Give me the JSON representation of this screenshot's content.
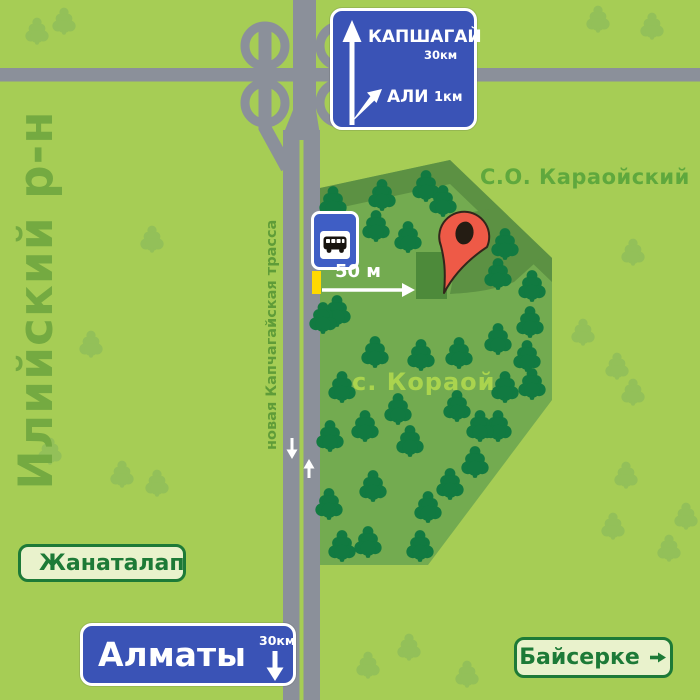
{
  "map": {
    "region_label": "Илийский р-н",
    "road_label": "новая Капчагайская трасса",
    "district_label": "С.О. Караойский",
    "village_label": "с. Кораой",
    "distance_label": "50 м",
    "colors": {
      "background": "#a6cd55",
      "road": "#8b909a",
      "forest": "#73ab50",
      "forest_shadow": "#5c9143",
      "tree_dark": "#117a41",
      "tree_light": "#93c059",
      "building": "#4d8a3a",
      "sign_blue": "#3a53b6",
      "bus_sign_blue": "#3f5ec5",
      "bus_stop_yellow": "#ffd900",
      "marker_red": "#ee5a47",
      "marker_outline": "#33261b",
      "green_sign_bg": "#e9f2cc",
      "green_sign_text": "#1d7a37",
      "district_text": "#5fa83d",
      "village_text": "#aad44e",
      "region_text": "#74aa41",
      "road_label_text": "#5f9c38"
    },
    "trees_dark": [
      [
        333,
        203
      ],
      [
        382,
        196
      ],
      [
        426,
        187
      ],
      [
        443,
        202
      ],
      [
        376,
        227
      ],
      [
        408,
        238
      ],
      [
        337,
        312
      ],
      [
        323,
        319
      ],
      [
        375,
        353
      ],
      [
        421,
        356
      ],
      [
        459,
        354
      ],
      [
        505,
        245
      ],
      [
        498,
        275
      ],
      [
        532,
        287
      ],
      [
        530,
        323
      ],
      [
        498,
        340
      ],
      [
        527,
        357
      ],
      [
        505,
        388
      ],
      [
        532,
        385
      ],
      [
        498,
        427
      ],
      [
        342,
        388
      ],
      [
        398,
        410
      ],
      [
        457,
        407
      ],
      [
        365,
        427
      ],
      [
        480,
        427
      ],
      [
        330,
        437
      ],
      [
        410,
        442
      ],
      [
        475,
        463
      ],
      [
        450,
        485
      ],
      [
        373,
        487
      ],
      [
        329,
        505
      ],
      [
        428,
        508
      ],
      [
        342,
        547
      ],
      [
        368,
        543
      ],
      [
        420,
        547
      ]
    ],
    "trees_light": [
      [
        37,
        32
      ],
      [
        64,
        22
      ],
      [
        598,
        20
      ],
      [
        652,
        27
      ],
      [
        152,
        240
      ],
      [
        91,
        345
      ],
      [
        50,
        452
      ],
      [
        122,
        475
      ],
      [
        157,
        484
      ],
      [
        633,
        253
      ],
      [
        583,
        333
      ],
      [
        617,
        367
      ],
      [
        633,
        393
      ],
      [
        626,
        476
      ],
      [
        613,
        527
      ],
      [
        669,
        549
      ],
      [
        686,
        517
      ],
      [
        409,
        648
      ],
      [
        368,
        666
      ],
      [
        467,
        675
      ]
    ]
  },
  "signs": {
    "highway": {
      "destination_primary": "КАПШАГАЙ",
      "distance_primary": "30км",
      "destination_secondary": "АЛИ",
      "distance_secondary": "1км"
    },
    "almaty": {
      "destination": "Алматы",
      "distance": "30км"
    },
    "zhanatalap": {
      "label": "Жанаталап"
    },
    "bayserke": {
      "label": "Байсерке"
    }
  }
}
